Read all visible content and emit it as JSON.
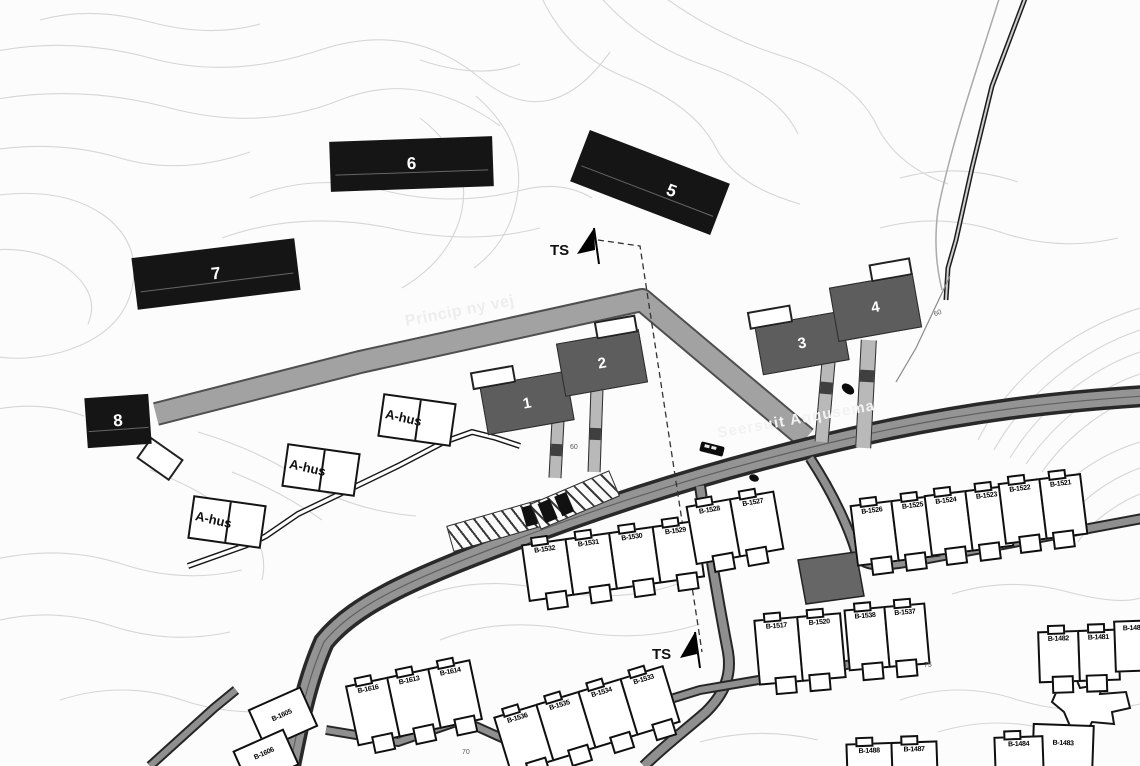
{
  "colors": {
    "black_building": "#151515",
    "gray_building": "#5d5d5d",
    "new_road": "#a2a2a2",
    "main_road": "#949494",
    "contour": "#d6d6d6"
  },
  "roads": {
    "new_road_label": "Princip ny vej",
    "main_road_label": "Seersuit Aqqusema"
  },
  "markers": {
    "ts_label": "TS"
  },
  "building_numbers": [
    "1",
    "2",
    "3",
    "4",
    "5",
    "6",
    "7",
    "8"
  ],
  "ahus_label": "A-hus",
  "houses": [
    "B-1532",
    "B-1531",
    "B-1530",
    "B-1529",
    "B-1528",
    "B-1527",
    "B-1526",
    "B-1525",
    "B-1524",
    "B-1523",
    "B-1522",
    "B-1521",
    "B-1536",
    "B-1535",
    "B-1534",
    "B-1533",
    "B-1616",
    "B-1613",
    "B-1614",
    "B-1605",
    "B-1606",
    "B-1517",
    "B-1520",
    "B-1538",
    "B-1537",
    "B-1482",
    "B-1481",
    "B-1480",
    "B-1483",
    "B-1488",
    "B-1487",
    "B-1484"
  ],
  "elevations": [
    "60",
    "60",
    "75",
    "70"
  ]
}
